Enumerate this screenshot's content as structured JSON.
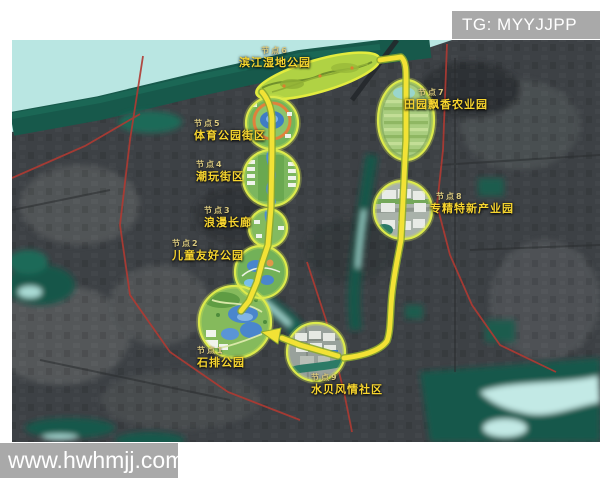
{
  "header": {
    "badge": "TG: MYYJJPP"
  },
  "watermark": "www.hwhmjj.com",
  "map": {
    "kind": "satellite master plan with looped greenway route and numbered nodes",
    "route_color": "#f2e235",
    "ring_color": "#dcea4c",
    "water_color": "#b9e6e2",
    "nodes": [
      {
        "id": "节点1",
        "name": "石排公园"
      },
      {
        "id": "节点2",
        "name": "儿童友好公园"
      },
      {
        "id": "节点3",
        "name": "浪漫长廊"
      },
      {
        "id": "节点4",
        "name": "潮玩街区"
      },
      {
        "id": "节点5",
        "name": "体育公园街区"
      },
      {
        "id": "节点6",
        "name": "滨江湿地公园"
      },
      {
        "id": "节点7",
        "name": "田园飘香农业园"
      },
      {
        "id": "节点8",
        "name": "专精特新产业园"
      },
      {
        "id": "节点9",
        "name": "水贝风情社区"
      }
    ]
  }
}
